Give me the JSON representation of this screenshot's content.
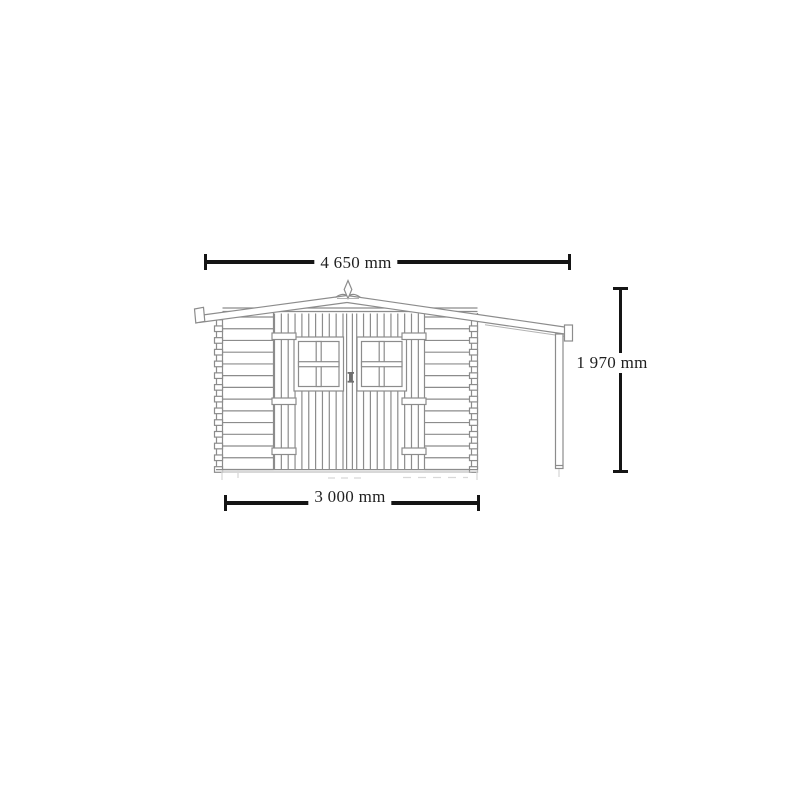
{
  "figure": {
    "type": "technical-drawing",
    "subject": "garden shed front elevation with double door, two windows and side canopy post"
  },
  "colors": {
    "bg": "#ffffff",
    "line": "#8c8c8c",
    "line_light": "#b2b2b2",
    "dim": "#151515",
    "text": "#1f1f1f",
    "faint": "#d8d8d8"
  },
  "dimensions": {
    "width_overall": {
      "label": "4 650 mm"
    },
    "height_wall": {
      "label": "1 970 mm"
    },
    "width_base": {
      "label": "3 000 mm"
    }
  }
}
